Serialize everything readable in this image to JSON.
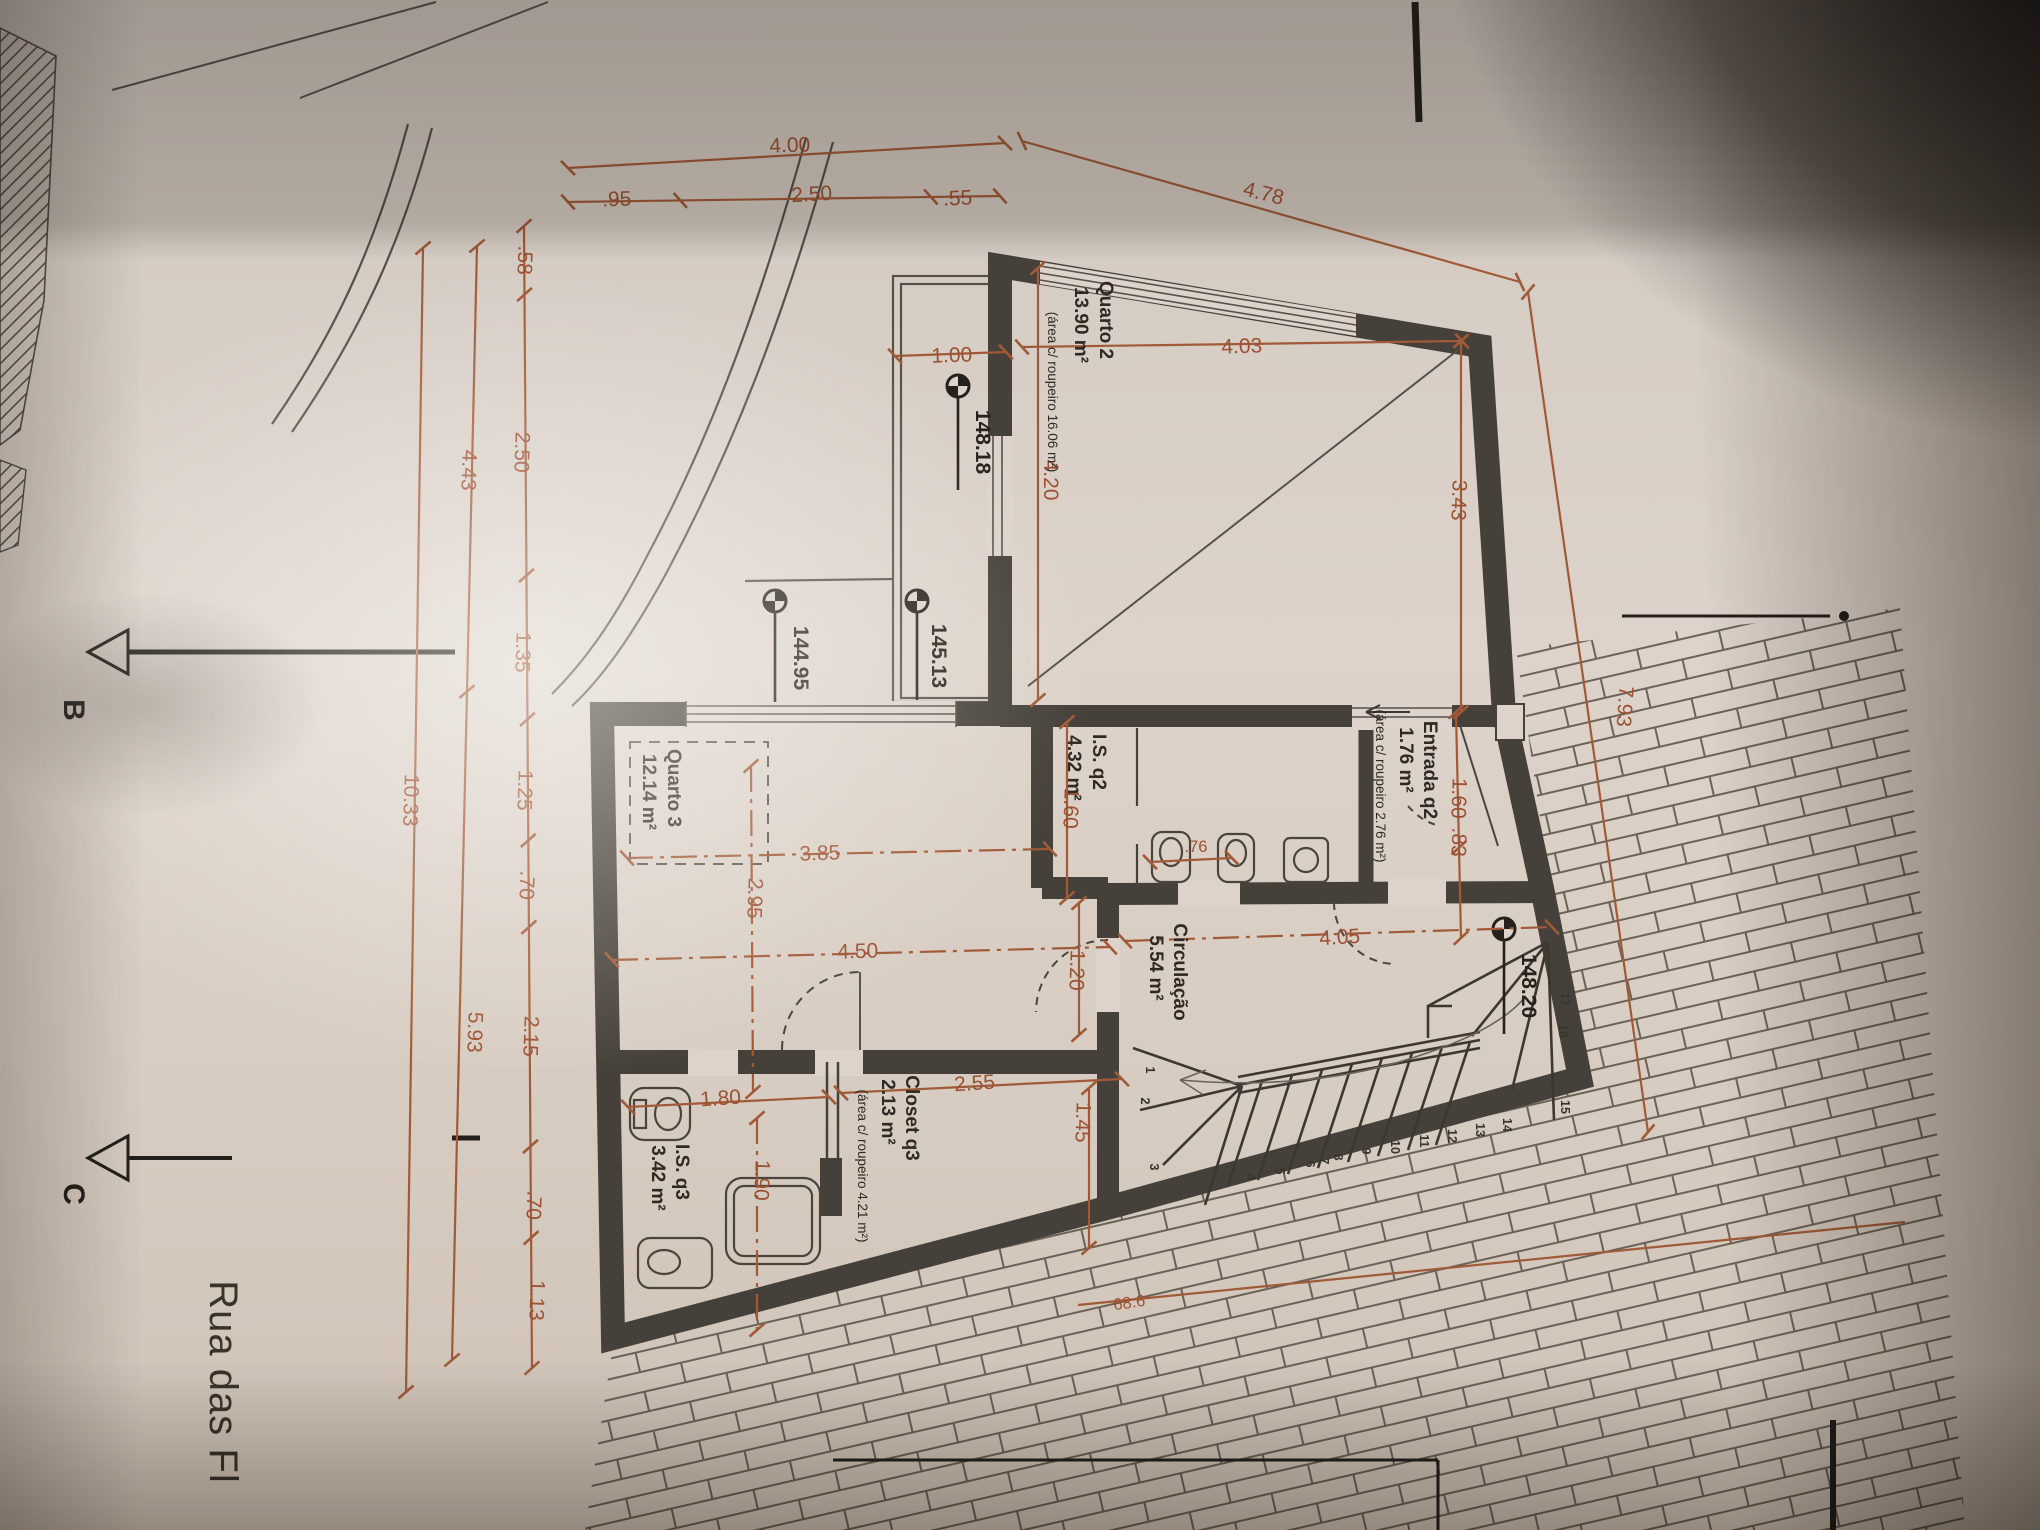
{
  "title": "floor-plan-photo",
  "colors": {
    "paper": "#ddd3ca",
    "walls": "#46403a",
    "thin_line": "#57504a",
    "dimension": "#9c5132",
    "text": "#2e2923"
  },
  "street_label": "Rua das Fl",
  "section_markers": [
    "B",
    "C"
  ],
  "levels": {
    "l1": "148.18",
    "l2": "144.95",
    "l3": "145.13",
    "l4": "148.20"
  },
  "rooms": {
    "quarto2": {
      "name": "Quarto 2",
      "area": "13.90 m²",
      "note": "(área c/ roupeiro 16.06 m²)"
    },
    "entrada_q2": {
      "name": "Entrada q2",
      "area": "1.76 m²",
      "note": "(área c/ roupeiro 2.76 m²)"
    },
    "is_q2": {
      "name": "I.S. q2",
      "area": "4.32 m²"
    },
    "quarto3": {
      "name": "Quarto 3",
      "area": "12.14 m²"
    },
    "circulacao": {
      "name": "Circulação",
      "area": "5.54 m²"
    },
    "closet_q3": {
      "name": "Closet q3",
      "area": "2.13 m²",
      "note": "(área c/ roupeiro 4.21 m²)"
    },
    "is_q3": {
      "name": "I.S. q3",
      "area": "3.42 m²"
    }
  },
  "dimensions": {
    "top_row1": [
      "4.00"
    ],
    "top_row2": [
      ".95",
      "2.50",
      ".55"
    ],
    "top_slant": "4.78",
    "left_lines": [
      "4.43",
      "10.33",
      "5.93"
    ],
    "left_chain": [
      ".58",
      "2.50",
      "1.35",
      "1.25",
      ".70",
      "2.15",
      ".70",
      "1.13"
    ],
    "right": [
      "3.43",
      "1.60",
      ".83",
      "7.93"
    ],
    "quarto2": [
      "1.00",
      "4.03",
      "4.20"
    ],
    "interior": [
      "3.85",
      "2.95",
      "4.50",
      "1.60",
      "1.20",
      "4.05",
      ".76"
    ],
    "bottom": [
      "1.80",
      "1.90",
      "2.55",
      "1.45"
    ],
    "site": "68.6"
  },
  "stairs": {
    "step_numbers": [
      "1",
      "2",
      "3",
      "4",
      "5",
      "6",
      "7",
      "8",
      "9",
      "10",
      "11",
      "12",
      "13",
      "14",
      "15",
      "16",
      "17"
    ]
  }
}
